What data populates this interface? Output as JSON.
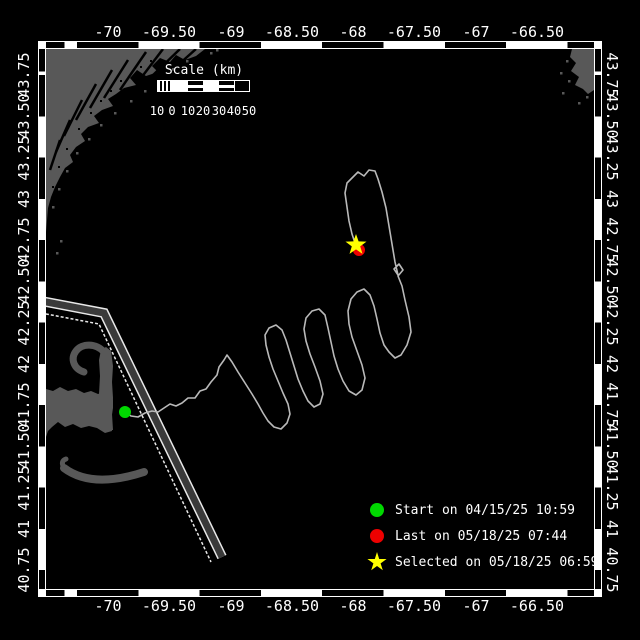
{
  "axes": {
    "lon_labels": [
      "-70",
      "-69.50",
      "-69",
      "-68.50",
      "-68",
      "-67.50",
      "-67",
      "-66.50"
    ],
    "lon_x": [
      108,
      169,
      231,
      292,
      353,
      414,
      476,
      537
    ],
    "lat_labels": [
      "43.75",
      "43.50",
      "43.25",
      "43",
      "42.75",
      "42.50",
      "42.25",
      "42",
      "41.75",
      "41.50",
      "41.25",
      "41",
      "40.75"
    ],
    "lat_y": [
      75,
      116,
      158,
      199,
      240,
      281,
      323,
      364,
      405,
      446,
      488,
      529,
      570
    ]
  },
  "scale_bar": {
    "title": "Scale (km)",
    "segments": [
      "hatch",
      "solid",
      "line",
      "solid",
      "line",
      "dark"
    ],
    "labels": [
      {
        "t": "10",
        "x": 157
      },
      {
        "t": "0",
        "x": 172
      },
      {
        "t": "10",
        "x": 188
      },
      {
        "t": "20",
        "x": 203
      },
      {
        "t": "30",
        "x": 219
      },
      {
        "t": "40",
        "x": 234
      },
      {
        "t": "50",
        "x": 249
      }
    ]
  },
  "legend": {
    "items": [
      {
        "marker": "start-dot",
        "color_key": "start",
        "label": "Start on 04/15/25 10:59"
      },
      {
        "marker": "last-dot",
        "color_key": "last",
        "label": "Last on 05/18/25 07:44"
      },
      {
        "marker": "selected-star",
        "color_key": "selected",
        "label": "Selected on 05/18/25 06:59"
      }
    ]
  },
  "colors": {
    "start": "#00d800",
    "last": "#ee0000",
    "selected": "#ffff00",
    "land": "#585858",
    "water": "#000000",
    "track": "#b9b9b9",
    "frame": "#ffffff",
    "lane_fill": "#3a3a3a",
    "lane_edge": "#e8e8e8"
  },
  "map": {
    "markers": {
      "start": {
        "x": 125,
        "y": 412,
        "r": 6
      },
      "last": {
        "x": 359,
        "y": 250,
        "r": 6
      },
      "selected": {
        "x": 356,
        "y": 245,
        "R": 11,
        "r": 4.4
      }
    },
    "track_points": "125,412 131,416 138,417 145,413 152,411 158,412 164,408 170,404 176,406 182,403 188,398 195,398 200,391 206,389 211,382 217,375 219,367 224,360 227,355 232,362 238,372 245,383 252,394 258,404 263,413 268,421 274,427 281,429 287,423 290,414 288,404 283,393 278,381 273,369 269,357 266,345 265,335 269,328 276,325 282,330 286,340 290,353 294,366 298,379 303,391 308,401 314,407 320,404 323,394 320,381 315,367 310,354 306,341 304,329 306,318 312,311 319,309 325,315 328,328 331,342 334,356 338,369 343,381 349,391 356,395 362,390 365,378 362,365 357,351 352,337 349,324 348,311 351,299 357,292 364,289 370,295 374,306 377,319 380,333 384,345 389,352 395,358 401,355 407,345 411,332 409,317 405,300 402,286 398,276 403,270 399,264 394,269 398,275 395,262 392,244 389,226 386,208 382,192 378,179 375,171 369,170 364,176 358,172 352,178 347,183 345,193 347,207 349,221 352,234 355,243 357,247",
    "lane": {
      "band": "41,301 104,313 222,557",
      "extra": "41,313 99,324 211,562"
    },
    "land": [
      {
        "name": "northwest-coastline",
        "type": "fill",
        "d": "M46,49 L205,49 L196,56 L185,60 L176,55 L170,62 L160,58 L152,66 L158,72 L146,76 L137,70 L130,78 L136,85 L124,88 L116,94 L108,99 L113,106 L102,110 L94,116 L99,123 L88,127 L81,134 L85,141 L76,147 L70,155 L73,162 L65,168 L60,177 L55,187 L51,197 L48,208 L47,220 L46,232 Z"
      },
      {
        "name": "northeast-coastline",
        "type": "fill",
        "d": "M572,49 L570,57 L576,63 L571,71 L579,77 L575,85 L583,89 L588,94 L594,90 L594,49 Z"
      },
      {
        "name": "cape-cod-arm",
        "type": "fill",
        "d": "M46,437 L46,389 L53,391 L60,387 L68,391 L76,389 L84,393 L91,391 L98,394 L104,392 L110,394 L113,400 L113,408 L111,421 L112,431 L105,433 L97,428 L89,426 L81,428 L73,424 L65,427 L58,422 L52,427 L48,431 Z"
      },
      {
        "name": "cape-cod-forearm",
        "type": "fill",
        "d": "M100,430 L99,394 L100,376 L99,360 L101,350 L106,347 L111,351 L113,366 L112,382 L113,398 L112,414 L113,430 Z"
      },
      {
        "name": "cape-cod-hook",
        "type": "stroke",
        "w": 7,
        "d": "M104,352 C96,343 82,343 76,351 C70,359 74,369 84,372"
      },
      {
        "name": "nantucket-island",
        "type": "stroke",
        "w": 8,
        "d": "M64,468 Q92,489 144,472"
      },
      {
        "name": "nantucket-tip",
        "type": "stroke",
        "w": 5,
        "d": "M64,468 Q60,461 66,459"
      }
    ],
    "rivers": [
      [
        196,
        49,
        168,
        74
      ],
      [
        180,
        49,
        150,
        78
      ],
      [
        163,
        49,
        138,
        82
      ],
      [
        146,
        52,
        120,
        90
      ],
      [
        128,
        60,
        104,
        98
      ],
      [
        112,
        70,
        90,
        108
      ],
      [
        96,
        84,
        76,
        120
      ],
      [
        82,
        100,
        64,
        136
      ],
      [
        70,
        120,
        56,
        152
      ],
      [
        60,
        140,
        50,
        170
      ]
    ],
    "speckles_gray": [
      [
        186,
        60
      ],
      [
        172,
        68
      ],
      [
        158,
        80
      ],
      [
        144,
        90
      ],
      [
        130,
        100
      ],
      [
        114,
        112
      ],
      [
        100,
        124
      ],
      [
        88,
        138
      ],
      [
        76,
        152
      ],
      [
        66,
        170
      ],
      [
        58,
        188
      ],
      [
        52,
        206
      ],
      [
        210,
        52
      ],
      [
        216,
        49
      ],
      [
        60,
        240
      ],
      [
        56,
        252
      ],
      [
        566,
        60
      ],
      [
        560,
        72
      ],
      [
        568,
        80
      ],
      [
        562,
        92
      ],
      [
        586,
        96
      ],
      [
        578,
        102
      ]
    ],
    "speckles_black": [
      [
        150,
        60
      ],
      [
        140,
        66
      ],
      [
        120,
        80
      ],
      [
        110,
        90
      ],
      [
        100,
        100
      ],
      [
        90,
        112
      ],
      [
        78,
        128
      ],
      [
        66,
        148
      ],
      [
        58,
        166
      ],
      [
        52,
        186
      ]
    ]
  }
}
